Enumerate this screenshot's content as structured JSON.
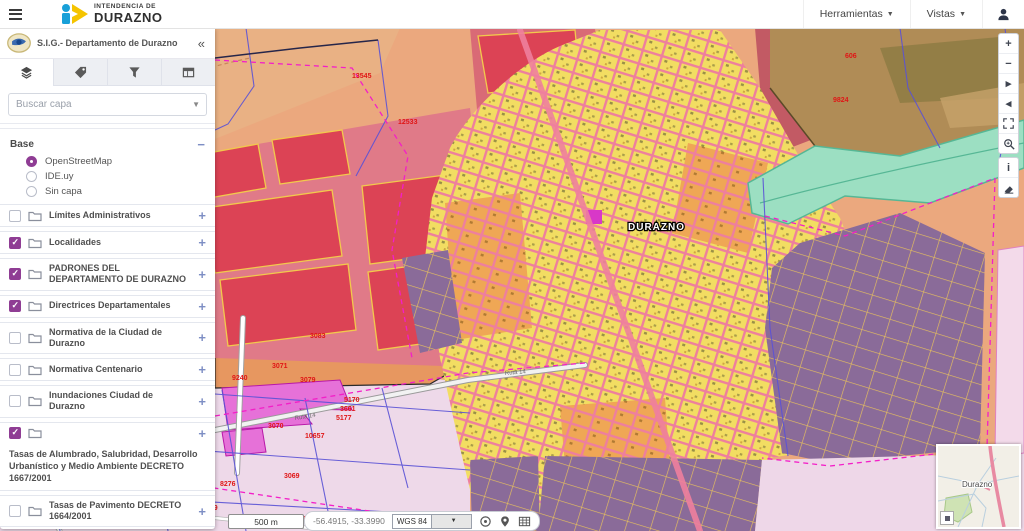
{
  "header": {
    "logo_top": "INTENDENCIA DE",
    "logo_bottom": "DURAZNO",
    "menus": [
      {
        "label": "Herramientas"
      },
      {
        "label": "Vistas"
      }
    ]
  },
  "sidebar": {
    "title": "S.I.G.- Departamento de Durazno",
    "collapse_glyph": "«",
    "search_placeholder": "Buscar capa",
    "base": {
      "title": "Base",
      "collapse_glyph": "−",
      "options": [
        {
          "label": "OpenStreetMap",
          "selected": true
        },
        {
          "label": "IDE.uy",
          "selected": false
        },
        {
          "label": "Sin capa",
          "selected": false
        }
      ]
    },
    "layers": [
      {
        "label": "Límites Administrativos",
        "checked": false
      },
      {
        "label": "Localidades",
        "checked": true
      },
      {
        "label": "PADRONES DEL DEPARTAMENTO DE DURAZNO",
        "checked": true
      },
      {
        "label": "Directrices Departamentales",
        "checked": true
      },
      {
        "label": "Normativa de la Ciudad de Durazno",
        "checked": false
      },
      {
        "label": "Normativa Centenario",
        "checked": false
      },
      {
        "label": "Inundaciones Ciudad de Durazno",
        "checked": false
      },
      {
        "label": "Tasas de Alumbrado, Salubridad, Desarrollo Urbanístico y Medio Ambiente DECRETO 1667/2001",
        "checked": true
      },
      {
        "label": "Tasas de Pavimento DECRETO 1664/2001",
        "checked": false
      }
    ],
    "expand_glyph": "+"
  },
  "map": {
    "city_label": "DURAZNO",
    "road_label": "Ruta 14",
    "parcel_labels": [
      {
        "text": "13545",
        "x": 352,
        "y": 50,
        "size": 8
      },
      {
        "text": "12533",
        "x": 398,
        "y": 96,
        "size": 8
      },
      {
        "text": "606",
        "x": 845,
        "y": 30
      },
      {
        "text": "9824",
        "x": 833,
        "y": 74
      },
      {
        "text": "3083",
        "x": 310,
        "y": 310
      },
      {
        "text": "3071",
        "x": 272,
        "y": 340
      },
      {
        "text": "9240",
        "x": 232,
        "y": 352
      },
      {
        "text": "3079",
        "x": 300,
        "y": 354
      },
      {
        "text": "5170",
        "x": 344,
        "y": 374
      },
      {
        "text": "3661",
        "x": 340,
        "y": 383
      },
      {
        "text": "5177",
        "x": 336,
        "y": 392
      },
      {
        "text": "3070",
        "x": 268,
        "y": 400
      },
      {
        "text": "10657",
        "x": 305,
        "y": 410
      },
      {
        "text": "3069",
        "x": 284,
        "y": 450
      },
      {
        "text": "8276",
        "x": 220,
        "y": 458
      },
      {
        "text": "1058",
        "x": 90,
        "y": 452
      },
      {
        "text": "9548",
        "x": 165,
        "y": 457
      },
      {
        "text": "1996",
        "x": 64,
        "y": 462
      },
      {
        "text": "8733",
        "x": 112,
        "y": 465
      },
      {
        "text": "1886",
        "x": 16,
        "y": 468
      },
      {
        "text": "899",
        "x": 206,
        "y": 482
      },
      {
        "text": "9446",
        "x": 157,
        "y": 484
      },
      {
        "text": "061",
        "x": 299,
        "y": 493
      }
    ],
    "controls": {
      "group1": [
        {
          "name": "zoom-in",
          "glyph": "+"
        },
        {
          "name": "zoom-out",
          "glyph": "−"
        },
        {
          "name": "pan-next",
          "glyph": "▸"
        },
        {
          "name": "pan-prev",
          "glyph": "◂"
        },
        {
          "name": "zoom-extent",
          "glyph": ""
        },
        {
          "name": "zoom-box",
          "glyph": ""
        }
      ],
      "group2": [
        {
          "name": "info",
          "glyph": "i"
        },
        {
          "name": "measure-erase",
          "glyph": ""
        }
      ]
    }
  },
  "statusbar": {
    "scale_label": "500 m",
    "coordinates": "-56.4915, -33.3990",
    "crs": "WGS 84"
  },
  "minimap": {
    "label": "Durazno"
  },
  "colors": {
    "accent_purple": "#8f3d94",
    "plus_blue": "#7d8ec4",
    "parcel_red": "#dc4355",
    "city_yellow": "#f2dd62",
    "street_pink": "#ee7f9d",
    "zone_purple": "#8a6b99",
    "river_teal": "#9cdfc2",
    "rural_salmon": "#eba87e",
    "label_red": "#e01616"
  }
}
